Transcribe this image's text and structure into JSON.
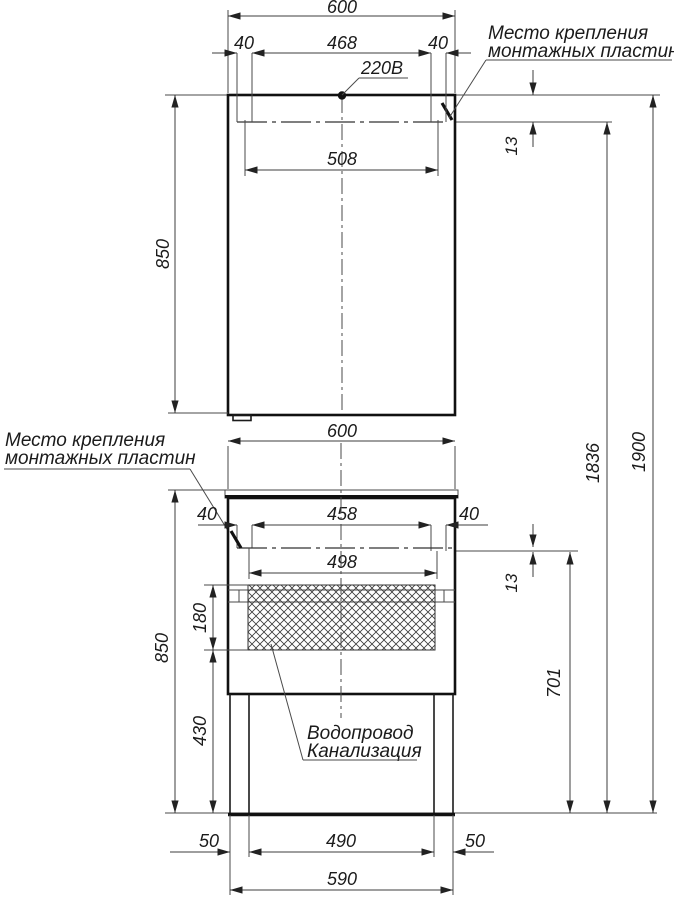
{
  "labels": {
    "mounting_top": {
      "line1": "Место крепления",
      "line2": "монтажных пластин"
    },
    "mounting_left": {
      "line1": "Место крепления",
      "line2": "монтажных пластин"
    },
    "power": "220В",
    "plumbing": {
      "line1": "Водопровод",
      "line2": "Канализация"
    }
  },
  "dimensions": {
    "mirror": {
      "width": "600",
      "plate_offset_left": "40",
      "plate_span": "468",
      "plate_offset_right": "40",
      "hole_span": "508",
      "plate_depth": "13",
      "height": "850"
    },
    "heights": {
      "plate_line_from_floor": "1836",
      "total": "1900",
      "plate_line_to_floor": "701"
    },
    "vanity": {
      "width": "600",
      "plate_offset_left": "40",
      "plate_span": "458",
      "plate_offset_right": "40",
      "hole_span": "498",
      "plate_depth": "13",
      "service_zone_height": "180",
      "height": "850",
      "under_zone_height": "430",
      "leg_offset_left": "50",
      "leg_span": "490",
      "leg_offset_right": "50",
      "base_width": "590"
    }
  }
}
